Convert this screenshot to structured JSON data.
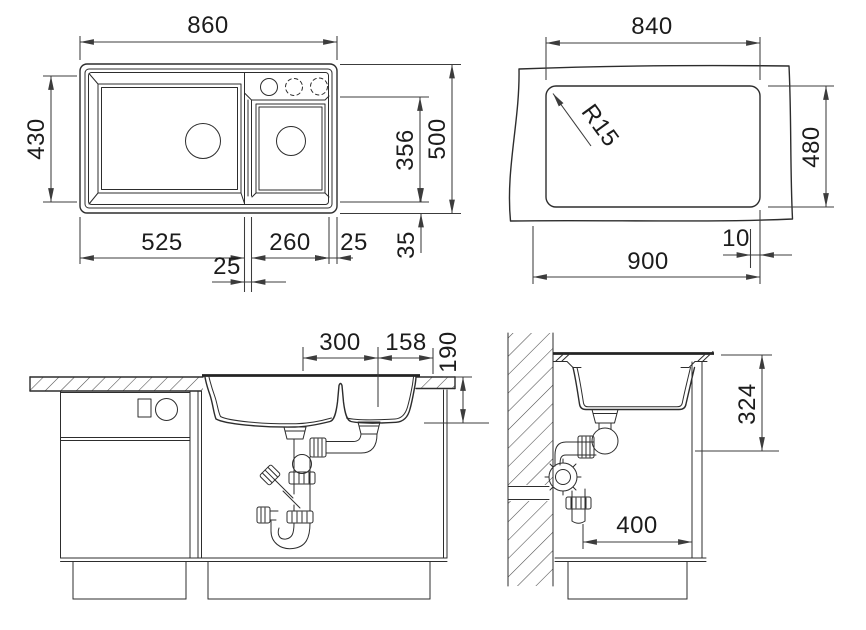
{
  "drawing": {
    "background": "#ffffff",
    "line_color": "#2d2d2d",
    "dimensions": {
      "plan": {
        "overall_width": "860",
        "main_bowl_depth": "430",
        "small_bowl_depth": "356",
        "overall_depth": "500",
        "main_bowl_width": "525",
        "bowl_gap": "25",
        "small_bowl_width": "260",
        "edge_offset": "25",
        "bottom_offset": "35"
      },
      "cutout": {
        "cutout_width": "840",
        "cutout_depth": "480",
        "corner_radius": "R15",
        "edge_gap": "10",
        "counter_width": "900"
      },
      "front": {
        "drain_offset": "300",
        "drain_to_edge": "158",
        "bowl_height": "190"
      },
      "side": {
        "outlet_height": "324",
        "base_clearance": "400"
      }
    }
  }
}
